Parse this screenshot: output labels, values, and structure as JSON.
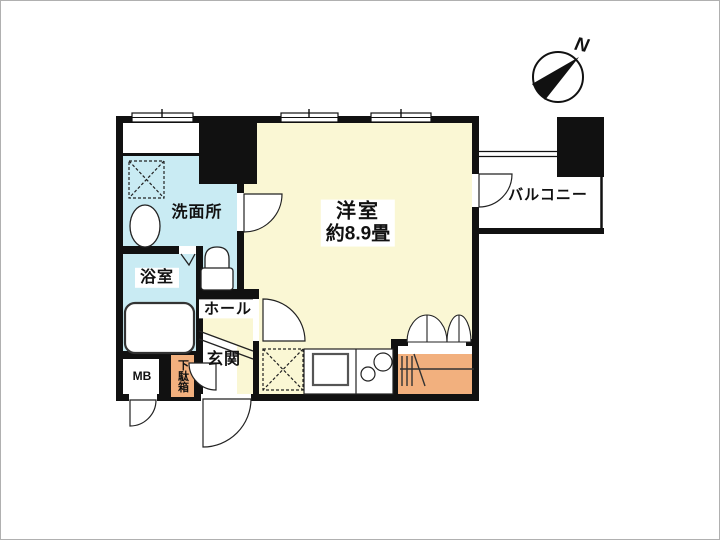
{
  "floorplan": {
    "compass": {
      "label": "N"
    },
    "rooms": {
      "main": {
        "label": "洋室",
        "size": "約8.9畳"
      },
      "washroom": {
        "label": "洗面所"
      },
      "bathroom": {
        "label": "浴室"
      },
      "hall": {
        "label": "ホール"
      },
      "entrance": {
        "label": "玄関"
      },
      "balcony": {
        "label": "バルコニー"
      },
      "meter_box": {
        "label": "MB"
      },
      "shoe_cabinet": {
        "label": "下駄箱"
      }
    },
    "colors": {
      "wall": "#111111",
      "floor_main": "#FAF7D4",
      "floor_wet": "#C9EBF3",
      "furniture_orange": "#F2B07E",
      "fixture_white": "#FFFFFF",
      "line": "#222222"
    }
  }
}
